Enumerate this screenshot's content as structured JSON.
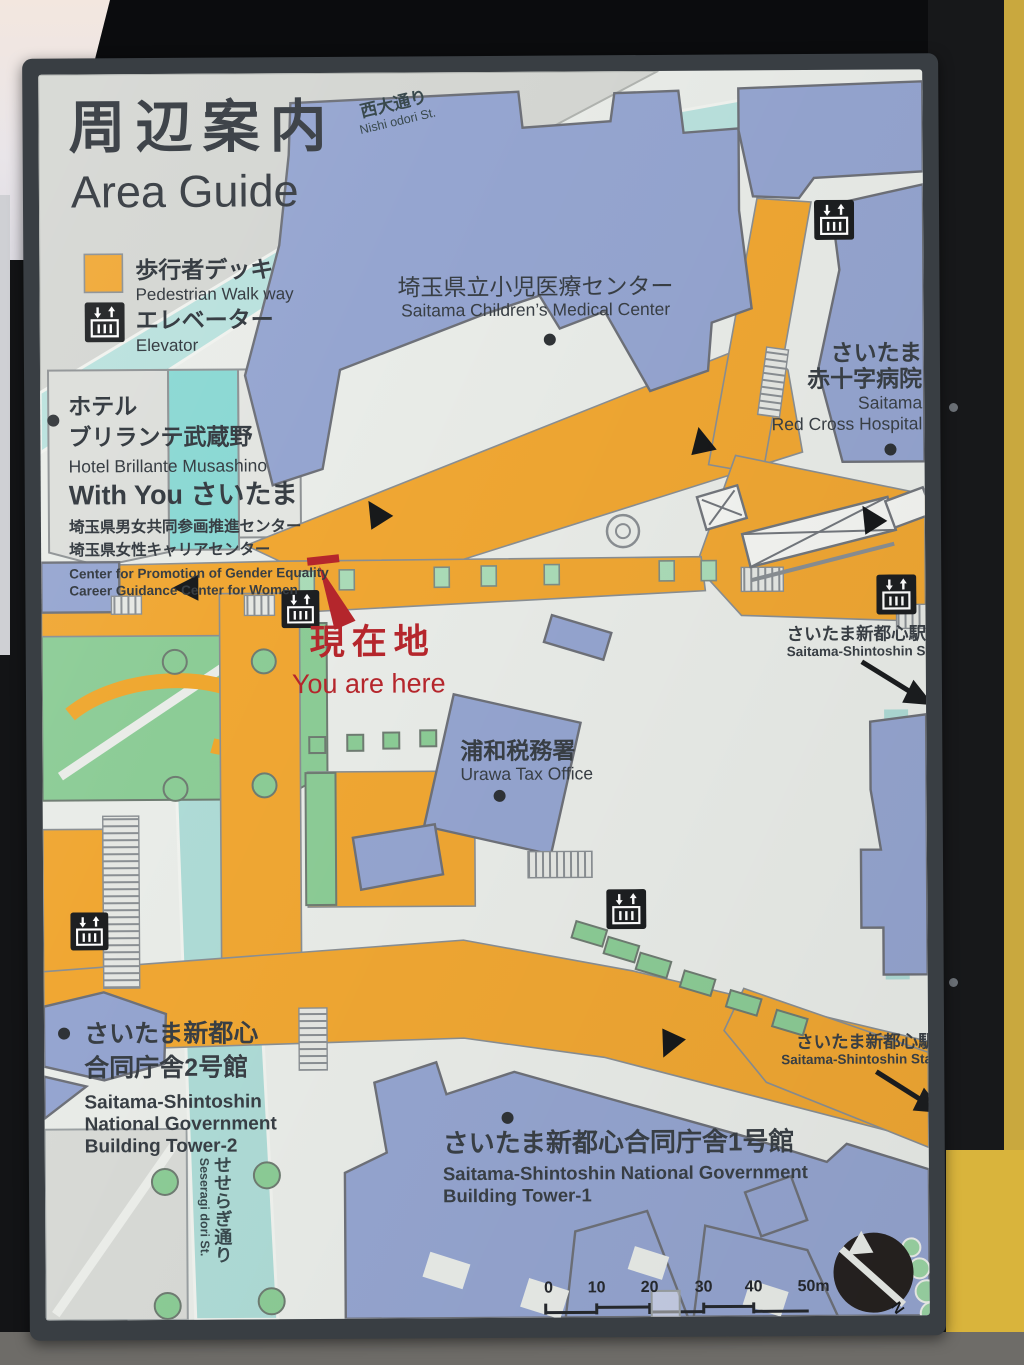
{
  "sign": {
    "title_jp": "周辺案内",
    "title_en": "Area Guide",
    "legend": {
      "walkway_jp": "歩行者デッキ",
      "walkway_en": "Pedestrian Walk way",
      "elevator_jp": "エレベーター",
      "elevator_en": "Elevator"
    },
    "labels": {
      "nishi_odori_jp": "西大通り",
      "nishi_odori_en": "Nishi odori St.",
      "medical_center_jp": "埼玉県立小児医療センター",
      "medical_center_en": "Saitama Children’s Medical Center",
      "red_cross_jp1": "さいたま",
      "red_cross_jp2": "赤十字病院",
      "red_cross_en1": "Saitama",
      "red_cross_en2": "Red Cross Hospital",
      "hotel_jp1": "ホテル",
      "hotel_jp2": "ブリランテ武蔵野",
      "hotel_en": "Hotel Brillante Musashino",
      "withyou": "With You さいたま",
      "gender_center_jp1": "埼玉県男女共同参画推進センター",
      "gender_center_jp2": "埼玉県女性キャリアセンター",
      "gender_center_en1": "Center for Promotion of Gender Equality",
      "gender_center_en2": "Career Guidance Center for Women",
      "you_are_here_jp": "現在地",
      "you_are_here_en": "You are here",
      "tax_office_jp": "浦和税務署",
      "tax_office_en": "Urawa Tax Office",
      "station_jp": "さいたま新都心駅",
      "station_en": "Saitama-Shintoshin Sta.",
      "tower2_jp1": "さいたま新都心",
      "tower2_jp2": "合同庁舎2号館",
      "tower2_en1": "Saitama-Shintoshin",
      "tower2_en2": "National Government",
      "tower2_en3": "Building Tower-2",
      "tower1_jp": "さいたま新都心合同庁舎1号館",
      "tower1_en1": "Saitama-Shintoshin National Government",
      "tower1_en2": "Building Tower-1",
      "seseragi_jp": "せせらぎ通り",
      "seseragi_en": "Seseragi dori St."
    },
    "scale": {
      "ticks": [
        "0",
        "10",
        "20",
        "30",
        "40",
        "50m"
      ]
    },
    "north_label": "N",
    "icons": [
      "elevator-icon",
      "north-arrow-icon",
      "direction-triangle-icon",
      "escalator-crossing-icon",
      "you-are-here-marker"
    ],
    "colors": {
      "deck_orange": "#F0A733",
      "building_blue": "#95A5D0",
      "road_teal": "#AEDBD6",
      "green": "#8CCC96",
      "marker_red": "#B5262C",
      "frame_gray": "#393E43",
      "icon_black": "#1D1F21",
      "paper": "#E9ECE8"
    }
  }
}
